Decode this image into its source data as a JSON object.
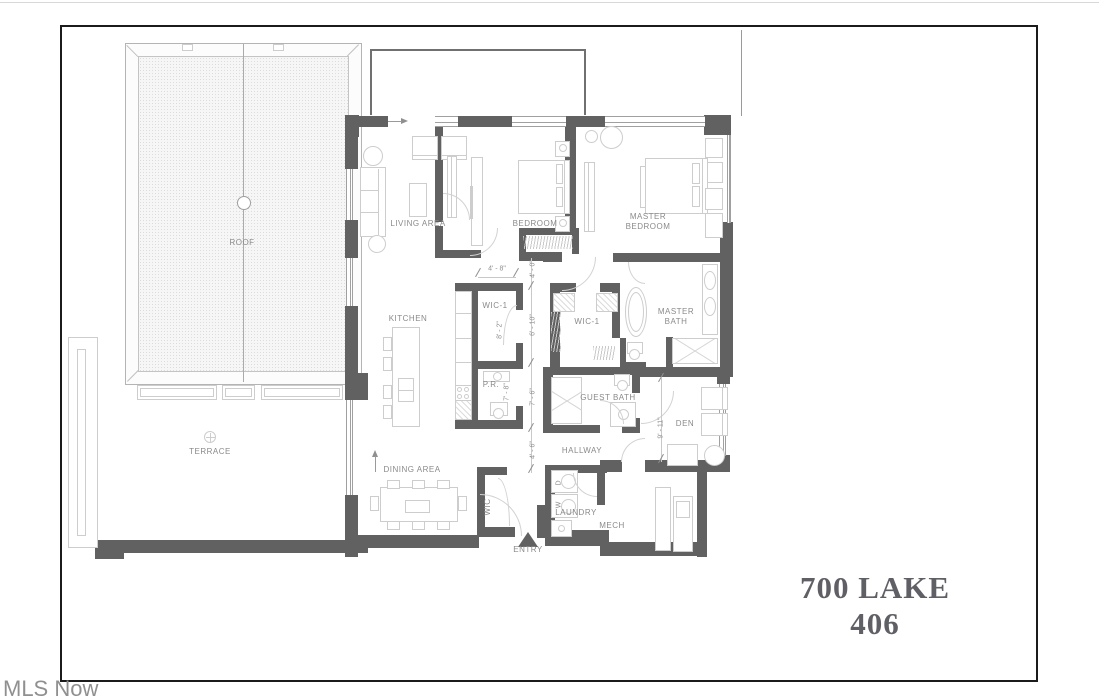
{
  "title": "700 LAKE 406",
  "watermark": "MLS Now",
  "rooms": {
    "roof": "ROOF",
    "terrace": "TERRACE",
    "living_area": "LIVING AREA",
    "bedroom": "BEDROOM",
    "master_bedroom": "MASTER BEDROOM",
    "kitchen": "KITCHEN",
    "wic1_kitchen": "WIC-1",
    "powder_room": "P.R.",
    "wic1_master": "WIC-1",
    "master_bath": "MASTER BATH",
    "guest_bath": "GUEST BATH",
    "den": "DEN",
    "hallway": "HALLWAY",
    "dining_area": "DINING AREA",
    "laundry": "LAUNDRY",
    "mech": "MECH",
    "entry": "ENTRY",
    "entry_closet": "WIC"
  },
  "appliances": {
    "washer": "W",
    "dryer": "D"
  },
  "dimensions": {
    "wic1_width": "4' - 8\"",
    "hall_upper": "4' - 0\"",
    "wic1_depth": "8' - 2\"",
    "hall_mid": "6' - 10\"",
    "powder_depth": "7' - 8\"",
    "hall_lower": "7' - 6\"",
    "entry_hall": "4' - 6\"",
    "den_depth": "9' - 11\""
  },
  "colors": {
    "wall": "#616161",
    "furniture_line": "#cdcdcd",
    "label_text": "#8a8a8a",
    "title_text": "#5f5f66",
    "frame_border": "#1b1b1b"
  }
}
